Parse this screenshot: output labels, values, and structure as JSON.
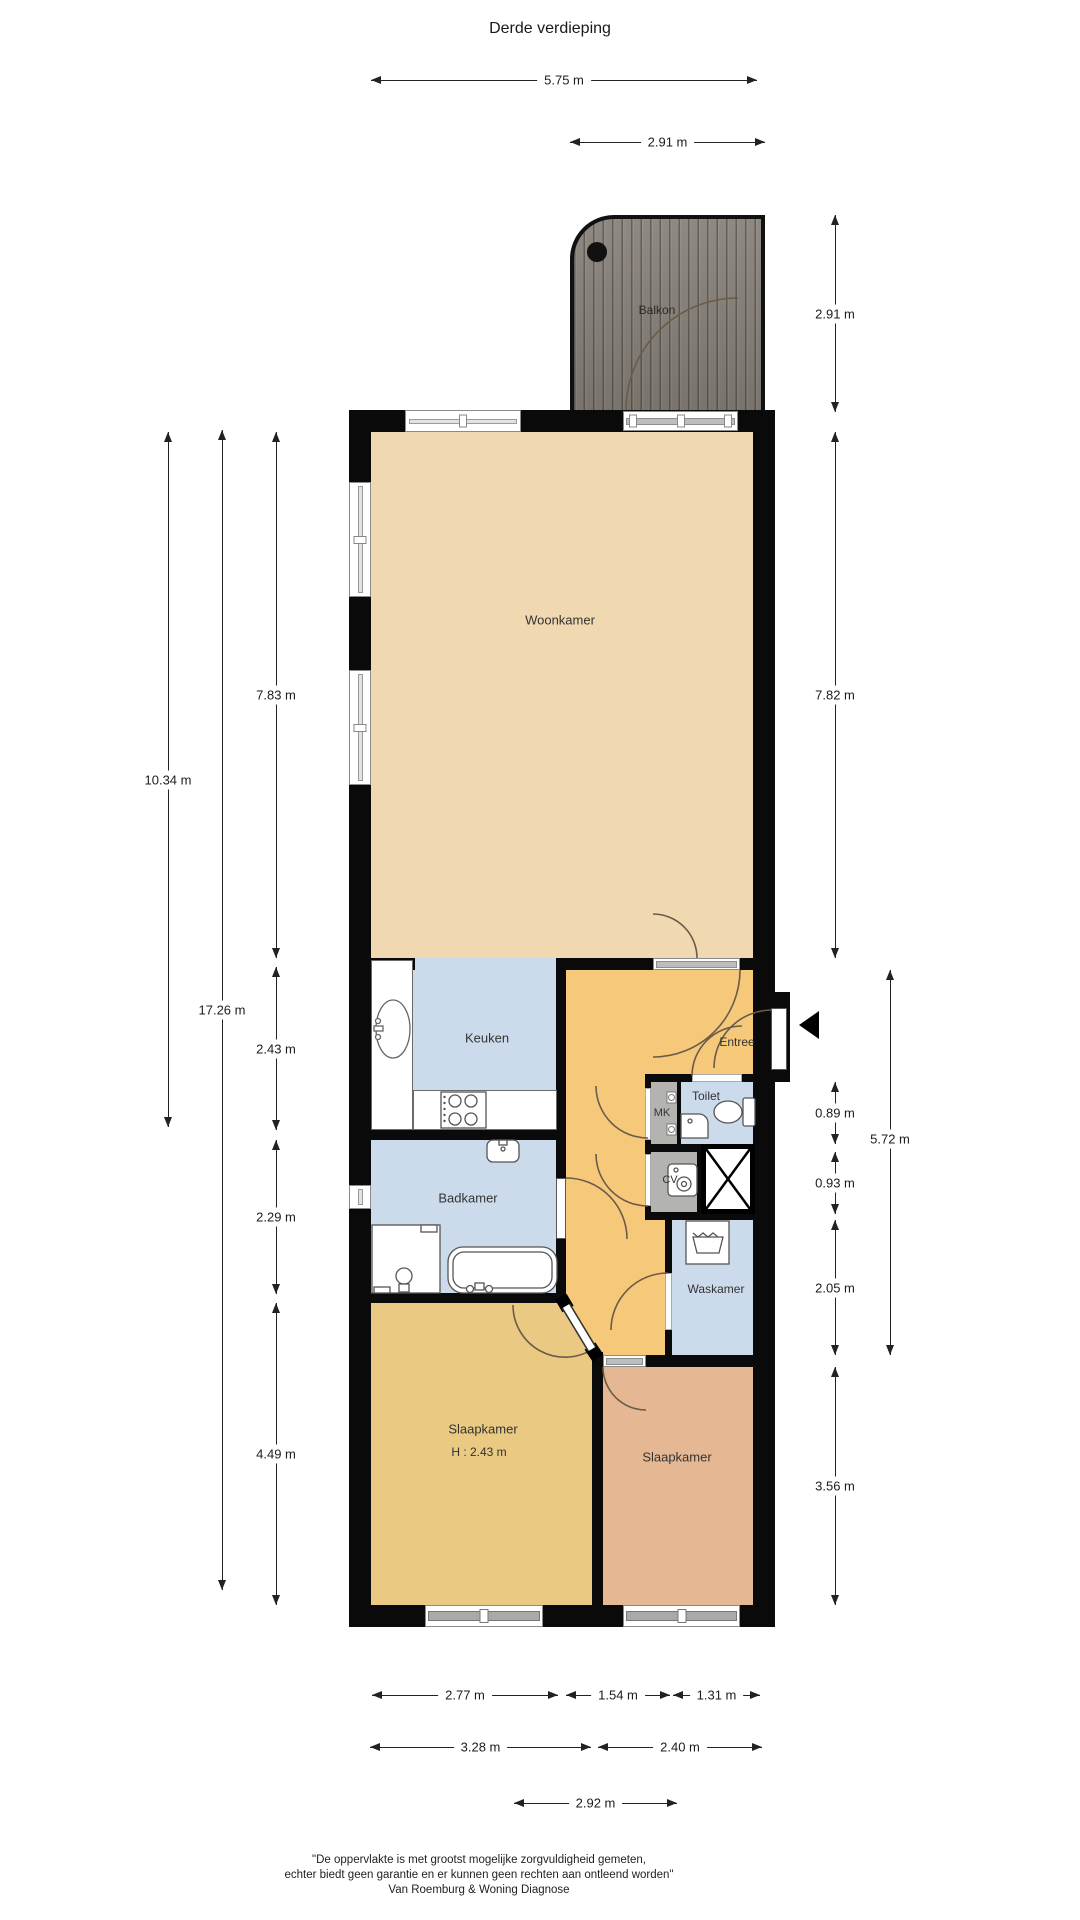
{
  "title": "Derde verdieping",
  "rooms": {
    "balkon": "Balkon",
    "woonkamer": "Woonkamer",
    "keuken": "Keuken",
    "entree": "Entree",
    "toilet": "Toilet",
    "mk": "MK",
    "cv": "CV",
    "badkamer": "Badkamer",
    "waskamer": "Waskamer",
    "slaapkamer1": "Slaapkamer",
    "slaapkamer1_height": "H : 2.43 m",
    "slaapkamer2": "Slaapkamer"
  },
  "dimensions": {
    "top": [
      {
        "label": "5.75 m"
      },
      {
        "label": "2.91 m"
      }
    ],
    "left": [
      {
        "label": "10.34 m"
      },
      {
        "label": "17.26 m"
      },
      {
        "label": "7.83 m"
      },
      {
        "label": "2.43 m"
      },
      {
        "label": "2.29 m"
      },
      {
        "label": "4.49 m"
      }
    ],
    "right": [
      {
        "label": "2.91 m"
      },
      {
        "label": "7.82 m"
      },
      {
        "label": "0.89 m"
      },
      {
        "label": "0.93 m"
      },
      {
        "label": "5.72 m"
      },
      {
        "label": "2.05 m"
      },
      {
        "label": "3.56 m"
      }
    ],
    "bottom": [
      {
        "label": "2.77 m"
      },
      {
        "label": "1.54 m"
      },
      {
        "label": "1.31 m"
      },
      {
        "label": "3.28 m"
      },
      {
        "label": "2.40 m"
      },
      {
        "label": "2.92 m"
      }
    ]
  },
  "footer": {
    "line1": "\"De oppervlakte is met grootst mogelijke zorgvuldigheid gemeten,",
    "line2": "echter biedt geen garantie en er kunnen geen rechten aan ontleend worden\"",
    "line3": "Van Roemburg & Woning Diagnose"
  },
  "colors": {
    "woonkamer": "#f0d9b1",
    "keuken_badkamer": "#cbdbeb",
    "hal": "#f6c87a",
    "slaapkamer1": "#eac983",
    "slaapkamer2": "#e5b893",
    "kast_grijs": "#b3b3b0",
    "wall": "#0a0a0a",
    "balkon_hout": "#868078"
  }
}
